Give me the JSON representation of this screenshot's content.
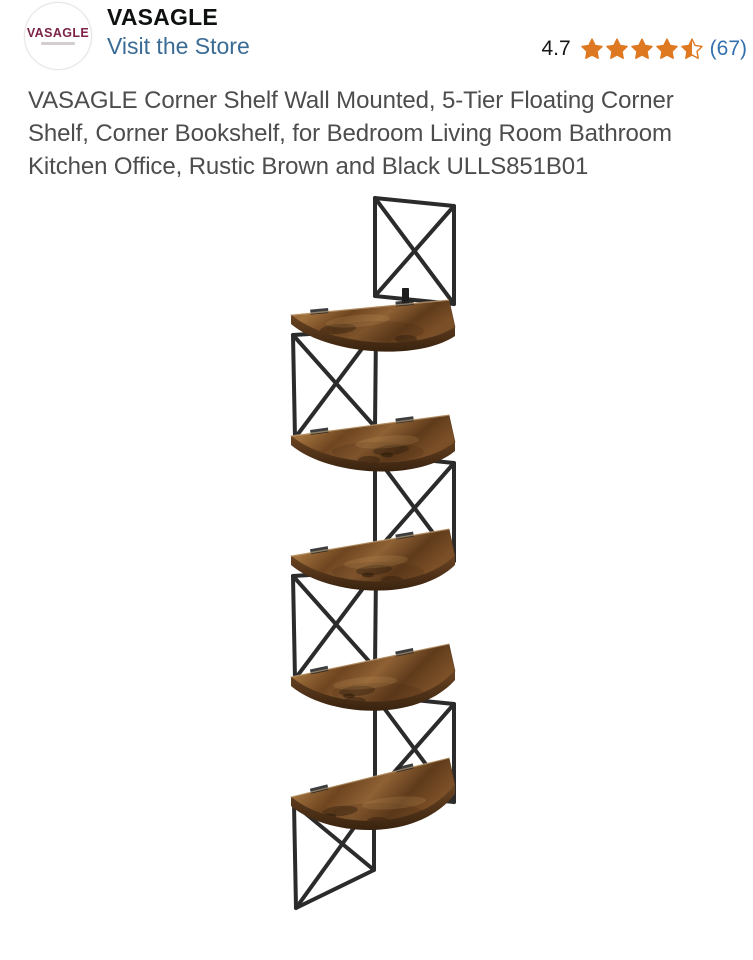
{
  "brand": {
    "logo_text": "VASAGLE",
    "name": "VASAGLE",
    "store_link_label": "Visit the Store"
  },
  "rating": {
    "score": "4.7",
    "display_stars": 4.5,
    "count_display": "(67)"
  },
  "product": {
    "title": "VASAGLE Corner Shelf Wall Mounted, 5-Tier Floating Corner Shelf, Corner Bookshelf, for Bedroom Living Room Bathroom Kitchen Office, Rustic Brown and Black ULLS851B01",
    "title_lines": [
      "VASAGLE Corner Shelf Wall Mounted, 5-Tier Floating Corner",
      "Shelf, Corner Bookshelf, for Bedroom Living Room Bathroom",
      "Kitchen Office, Rustic Brown and Black ULLS851B01"
    ]
  },
  "image": {
    "description": "5-tier wall-mounted zigzag corner shelf, rustic brown wood shelves with black metal X-frames",
    "tiers": 5
  },
  "colors": {
    "star_orange": "#de7921",
    "store_link_blue": "#3a6b94",
    "rating_count_blue": "#3470ad",
    "title_gray": "#4d4d4d",
    "brand_maroon": "#7c2347",
    "metal_black": "#2b2b2b",
    "wood_brown": "#8a5a2c"
  }
}
